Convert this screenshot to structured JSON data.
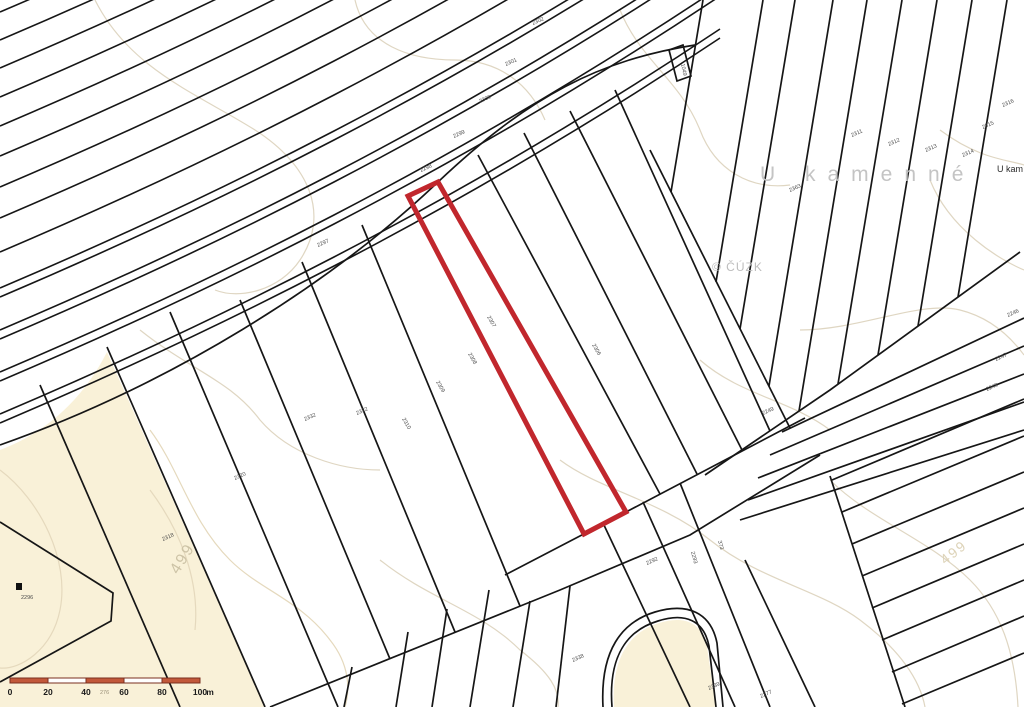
{
  "map": {
    "place_label": "U kamenné",
    "place_label_partial": "U kam",
    "watermark": "© ČÚZK",
    "highlight_color": "#c1272d",
    "contour_labels": [
      {
        "text": "499",
        "x": 178,
        "y": 575,
        "rot": -58,
        "size": 16,
        "color": "#cdc3a6"
      },
      {
        "text": "499",
        "x": 945,
        "y": 565,
        "rot": -38,
        "size": 14,
        "color": "#ddd3b8"
      }
    ],
    "parcel_labels": [
      {
        "text": "2302",
        "x": 533,
        "y": 25,
        "rot": -24
      },
      {
        "text": "2301",
        "x": 506,
        "y": 66,
        "rot": -24
      },
      {
        "text": "2300",
        "x": 480,
        "y": 103,
        "rot": -24
      },
      {
        "text": "2299",
        "x": 454,
        "y": 138,
        "rot": -24
      },
      {
        "text": "2298",
        "x": 421,
        "y": 172,
        "rot": -24
      },
      {
        "text": "2297",
        "x": 318,
        "y": 247,
        "rot": -24
      },
      {
        "text": "2307",
        "x": 487,
        "y": 317,
        "rot": 60
      },
      {
        "text": "2306",
        "x": 592,
        "y": 345,
        "rot": 60
      },
      {
        "text": "2308",
        "x": 468,
        "y": 354,
        "rot": 60
      },
      {
        "text": "2309",
        "x": 436,
        "y": 382,
        "rot": 60
      },
      {
        "text": "2310",
        "x": 402,
        "y": 419,
        "rot": 60
      },
      {
        "text": "2322",
        "x": 357,
        "y": 415,
        "rot": -24
      },
      {
        "text": "2332",
        "x": 305,
        "y": 421,
        "rot": -24
      },
      {
        "text": "2320",
        "x": 235,
        "y": 480,
        "rot": -24
      },
      {
        "text": "2318",
        "x": 163,
        "y": 541,
        "rot": -24
      },
      {
        "text": "2311",
        "x": 852,
        "y": 137,
        "rot": -24
      },
      {
        "text": "2312",
        "x": 889,
        "y": 146,
        "rot": -24
      },
      {
        "text": "2313",
        "x": 926,
        "y": 152,
        "rot": -24
      },
      {
        "text": "2314",
        "x": 963,
        "y": 157,
        "rot": -24
      },
      {
        "text": "2315",
        "x": 983,
        "y": 129,
        "rot": -24
      },
      {
        "text": "2316",
        "x": 1003,
        "y": 107,
        "rot": -24
      },
      {
        "text": "2363",
        "x": 790,
        "y": 192,
        "rot": -24
      },
      {
        "text": "2246",
        "x": 1008,
        "y": 317,
        "rot": -24
      },
      {
        "text": "2247",
        "x": 996,
        "y": 361,
        "rot": -24
      },
      {
        "text": "2248",
        "x": 987,
        "y": 391,
        "rot": -24
      },
      {
        "text": "2249",
        "x": 763,
        "y": 415,
        "rot": -24
      },
      {
        "text": "2292",
        "x": 647,
        "y": 565,
        "rot": -24
      },
      {
        "text": "2293",
        "x": 691,
        "y": 552,
        "rot": 75
      },
      {
        "text": "373",
        "x": 718,
        "y": 541,
        "rot": 75
      },
      {
        "text": "2338",
        "x": 573,
        "y": 662,
        "rot": -24
      },
      {
        "text": "2339",
        "x": 709,
        "y": 690,
        "rot": -24
      },
      {
        "text": "2277",
        "x": 761,
        "y": 698,
        "rot": -24
      },
      {
        "text": "1049",
        "x": 681,
        "y": 64,
        "rot": 78
      },
      {
        "text": "2296",
        "x": 21,
        "y": 599,
        "rot": 0
      },
      {
        "text": "276",
        "x": 100,
        "y": 694,
        "rot": 0,
        "color": "#9a9078"
      }
    ],
    "scale_bar": {
      "x": 10,
      "y": 678,
      "width": 190,
      "height": 5,
      "segments": 5,
      "ticks": [
        "0",
        "20",
        "40",
        "60",
        "80",
        "100"
      ],
      "unit": "m",
      "fill": "#c2583a",
      "stroke": "#7a2f1f",
      "label_color": "#1a1a1a"
    }
  }
}
